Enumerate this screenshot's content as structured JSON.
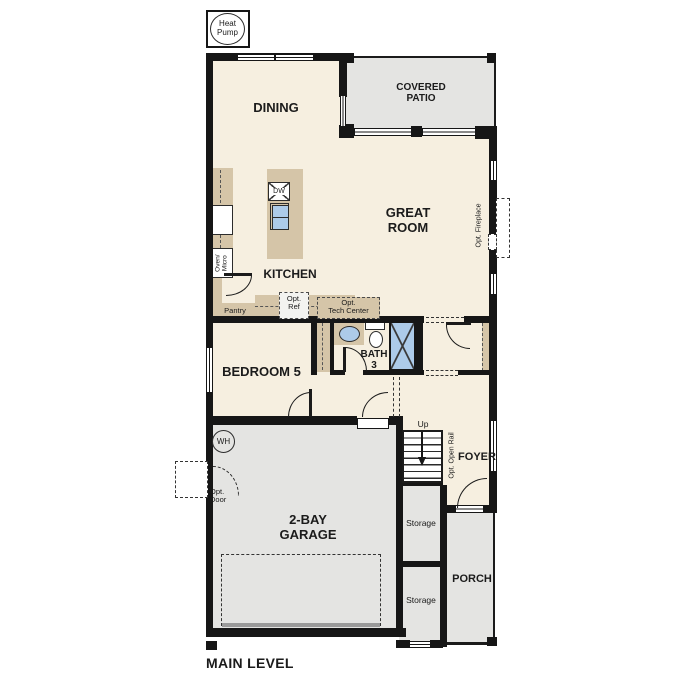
{
  "plan_title": "MAIN LEVEL",
  "colors": {
    "floor_cream": "#f6efe0",
    "floor_gray": "#e4e4e2",
    "counter_tan": "#d5c5a8",
    "fixture_blue": "#adcbe9",
    "wall_black": "#161616"
  },
  "equipment": {
    "heat_pump": {
      "lines": [
        "Heat",
        "Pump"
      ]
    },
    "water_heater": "WH"
  },
  "rooms": {
    "dining": {
      "label": "DINING"
    },
    "covered_patio": {
      "lines": [
        "COVERED",
        "PATIO"
      ]
    },
    "great_room": {
      "lines": [
        "GREAT",
        "ROOM"
      ]
    },
    "kitchen": {
      "label": "KITCHEN"
    },
    "pantry": {
      "label": "Pantry"
    },
    "bedroom5": {
      "label": "BEDROOM 5"
    },
    "bath3": {
      "lines": [
        "BATH",
        "3"
      ]
    },
    "garage": {
      "lines": [
        "2-BAY",
        "GARAGE"
      ]
    },
    "foyer": {
      "label": "FOYER"
    },
    "storage_upper": {
      "label": "Storage"
    },
    "storage_lower": {
      "label": "Storage"
    },
    "porch": {
      "label": "PORCH"
    }
  },
  "features": {
    "dishwasher": "DW",
    "oven_micro": {
      "lines": [
        "Oven/",
        "Micro"
      ]
    },
    "opt_ref": {
      "lines": [
        "Opt.",
        "Ref"
      ]
    },
    "opt_tech_center": {
      "lines": [
        "Opt.",
        "Tech Center"
      ]
    },
    "opt_fireplace": "Opt. Fireplace",
    "opt_door": {
      "lines": [
        "Opt.",
        "Door"
      ]
    },
    "opt_open_rail": "Opt. Open Rail",
    "stairs_up": "Up"
  }
}
